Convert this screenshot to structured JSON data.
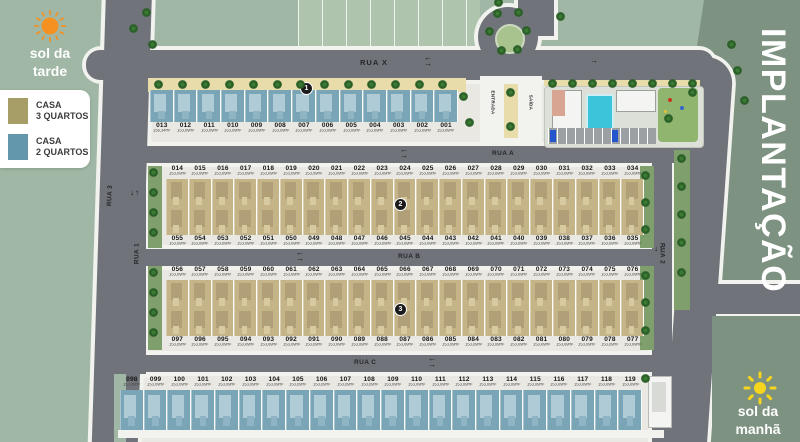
{
  "title": "IMPLANTAÇÃO",
  "legend": {
    "items": [
      {
        "key": "casa-3-quartos",
        "line1": "CASA",
        "line2": "3 QUARTOS",
        "swatch": "#a79d66"
      },
      {
        "key": "casa-2-quartos",
        "line1": "CASA",
        "line2": "2 QUARTOS",
        "swatch": "#6397ab"
      }
    ]
  },
  "suns": {
    "afternoon": {
      "line1": "sol da",
      "line2": "tarde",
      "color": "#f59120"
    },
    "morning": {
      "line1": "sol da",
      "line2": "manhã",
      "color": "#f7d51d"
    }
  },
  "streets": {
    "x": "RUA X",
    "a": "RUA A",
    "b": "RUA B",
    "c": "RUA C",
    "n1": "RUA 1",
    "n2": "RUA 2",
    "n3": "RUA 3"
  },
  "gate": {
    "entrance": "ENTRADA",
    "exit": "SAÍDA"
  },
  "badges": {
    "b1": "1",
    "b2": "2",
    "b3": "3"
  },
  "default_area": "153,09m²",
  "area_overrides": {
    "013": "156,34m²",
    "098": "157,39m²"
  },
  "rows": [
    {
      "id": "row1",
      "type": "casa-2-quartos",
      "numbers": [
        "013",
        "012",
        "011",
        "010",
        "009",
        "008",
        "007",
        "006",
        "005",
        "004",
        "003",
        "002",
        "001"
      ]
    },
    {
      "id": "row2",
      "type": "casa-3-quartos",
      "numbers": [
        "014",
        "015",
        "016",
        "017",
        "018",
        "019",
        "020",
        "021",
        "022",
        "023",
        "024",
        "025",
        "026",
        "027",
        "028",
        "029",
        "030",
        "031",
        "032",
        "033",
        "034"
      ]
    },
    {
      "id": "row3",
      "type": "casa-3-quartos",
      "numbers": [
        "055",
        "054",
        "053",
        "052",
        "051",
        "050",
        "049",
        "048",
        "047",
        "046",
        "045",
        "044",
        "043",
        "042",
        "041",
        "040",
        "039",
        "038",
        "037",
        "036",
        "035"
      ]
    },
    {
      "id": "row4",
      "type": "casa-3-quartos",
      "numbers": [
        "056",
        "057",
        "058",
        "059",
        "060",
        "061",
        "062",
        "063",
        "064",
        "065",
        "066",
        "067",
        "068",
        "069",
        "070",
        "071",
        "072",
        "073",
        "074",
        "075",
        "076"
      ]
    },
    {
      "id": "row5",
      "type": "casa-3-quartos",
      "numbers": [
        "097",
        "096",
        "095",
        "094",
        "093",
        "092",
        "091",
        "090",
        "089",
        "088",
        "087",
        "086",
        "085",
        "084",
        "083",
        "082",
        "081",
        "080",
        "079",
        "078",
        "077"
      ]
    },
    {
      "id": "row6",
      "type": "casa-2-quartos",
      "numbers": [
        "098",
        "099",
        "100",
        "101",
        "102",
        "103",
        "104",
        "105",
        "106",
        "107",
        "108",
        "109",
        "110",
        "111",
        "112",
        "113",
        "114",
        "115",
        "116",
        "117",
        "118",
        "119"
      ]
    }
  ]
}
